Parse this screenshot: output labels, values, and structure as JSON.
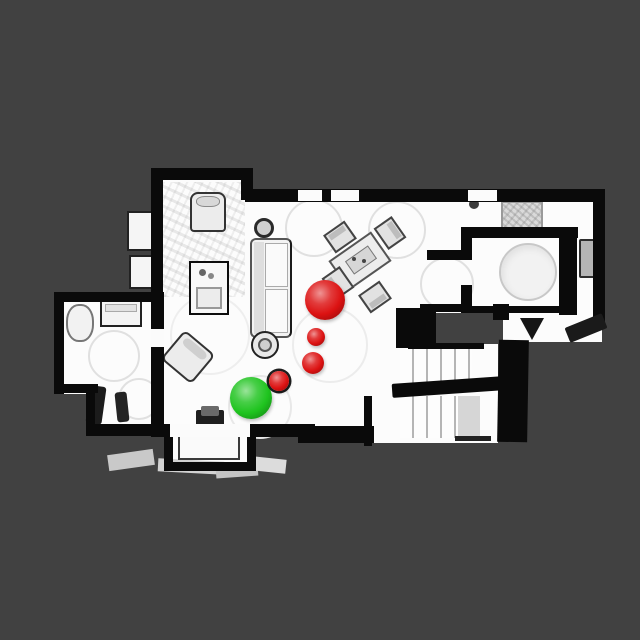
{
  "viewer": {
    "background_color": "#414141",
    "floor_color": "#fcfcfc",
    "wall_color": "#0a0a0a",
    "scene_label": "top-down-apartment-scan"
  },
  "markers": {
    "goal": {
      "label": "goal-marker",
      "color": "#1fc41f",
      "cx": 251,
      "cy": 398,
      "r": 21
    },
    "waypoints": [
      {
        "label": "waypoint-marker-1",
        "color": "#dc1212",
        "cx": 325,
        "cy": 300,
        "r": 20
      },
      {
        "label": "waypoint-marker-2",
        "color": "#dc1212",
        "cx": 316,
        "cy": 337,
        "r": 9
      },
      {
        "label": "waypoint-marker-3",
        "color": "#dc1212",
        "cx": 313,
        "cy": 363,
        "r": 11
      },
      {
        "label": "waypoint-marker-4",
        "color": "#dc1212",
        "cx": 279,
        "cy": 381,
        "r": 10,
        "outlined": true
      }
    ]
  }
}
